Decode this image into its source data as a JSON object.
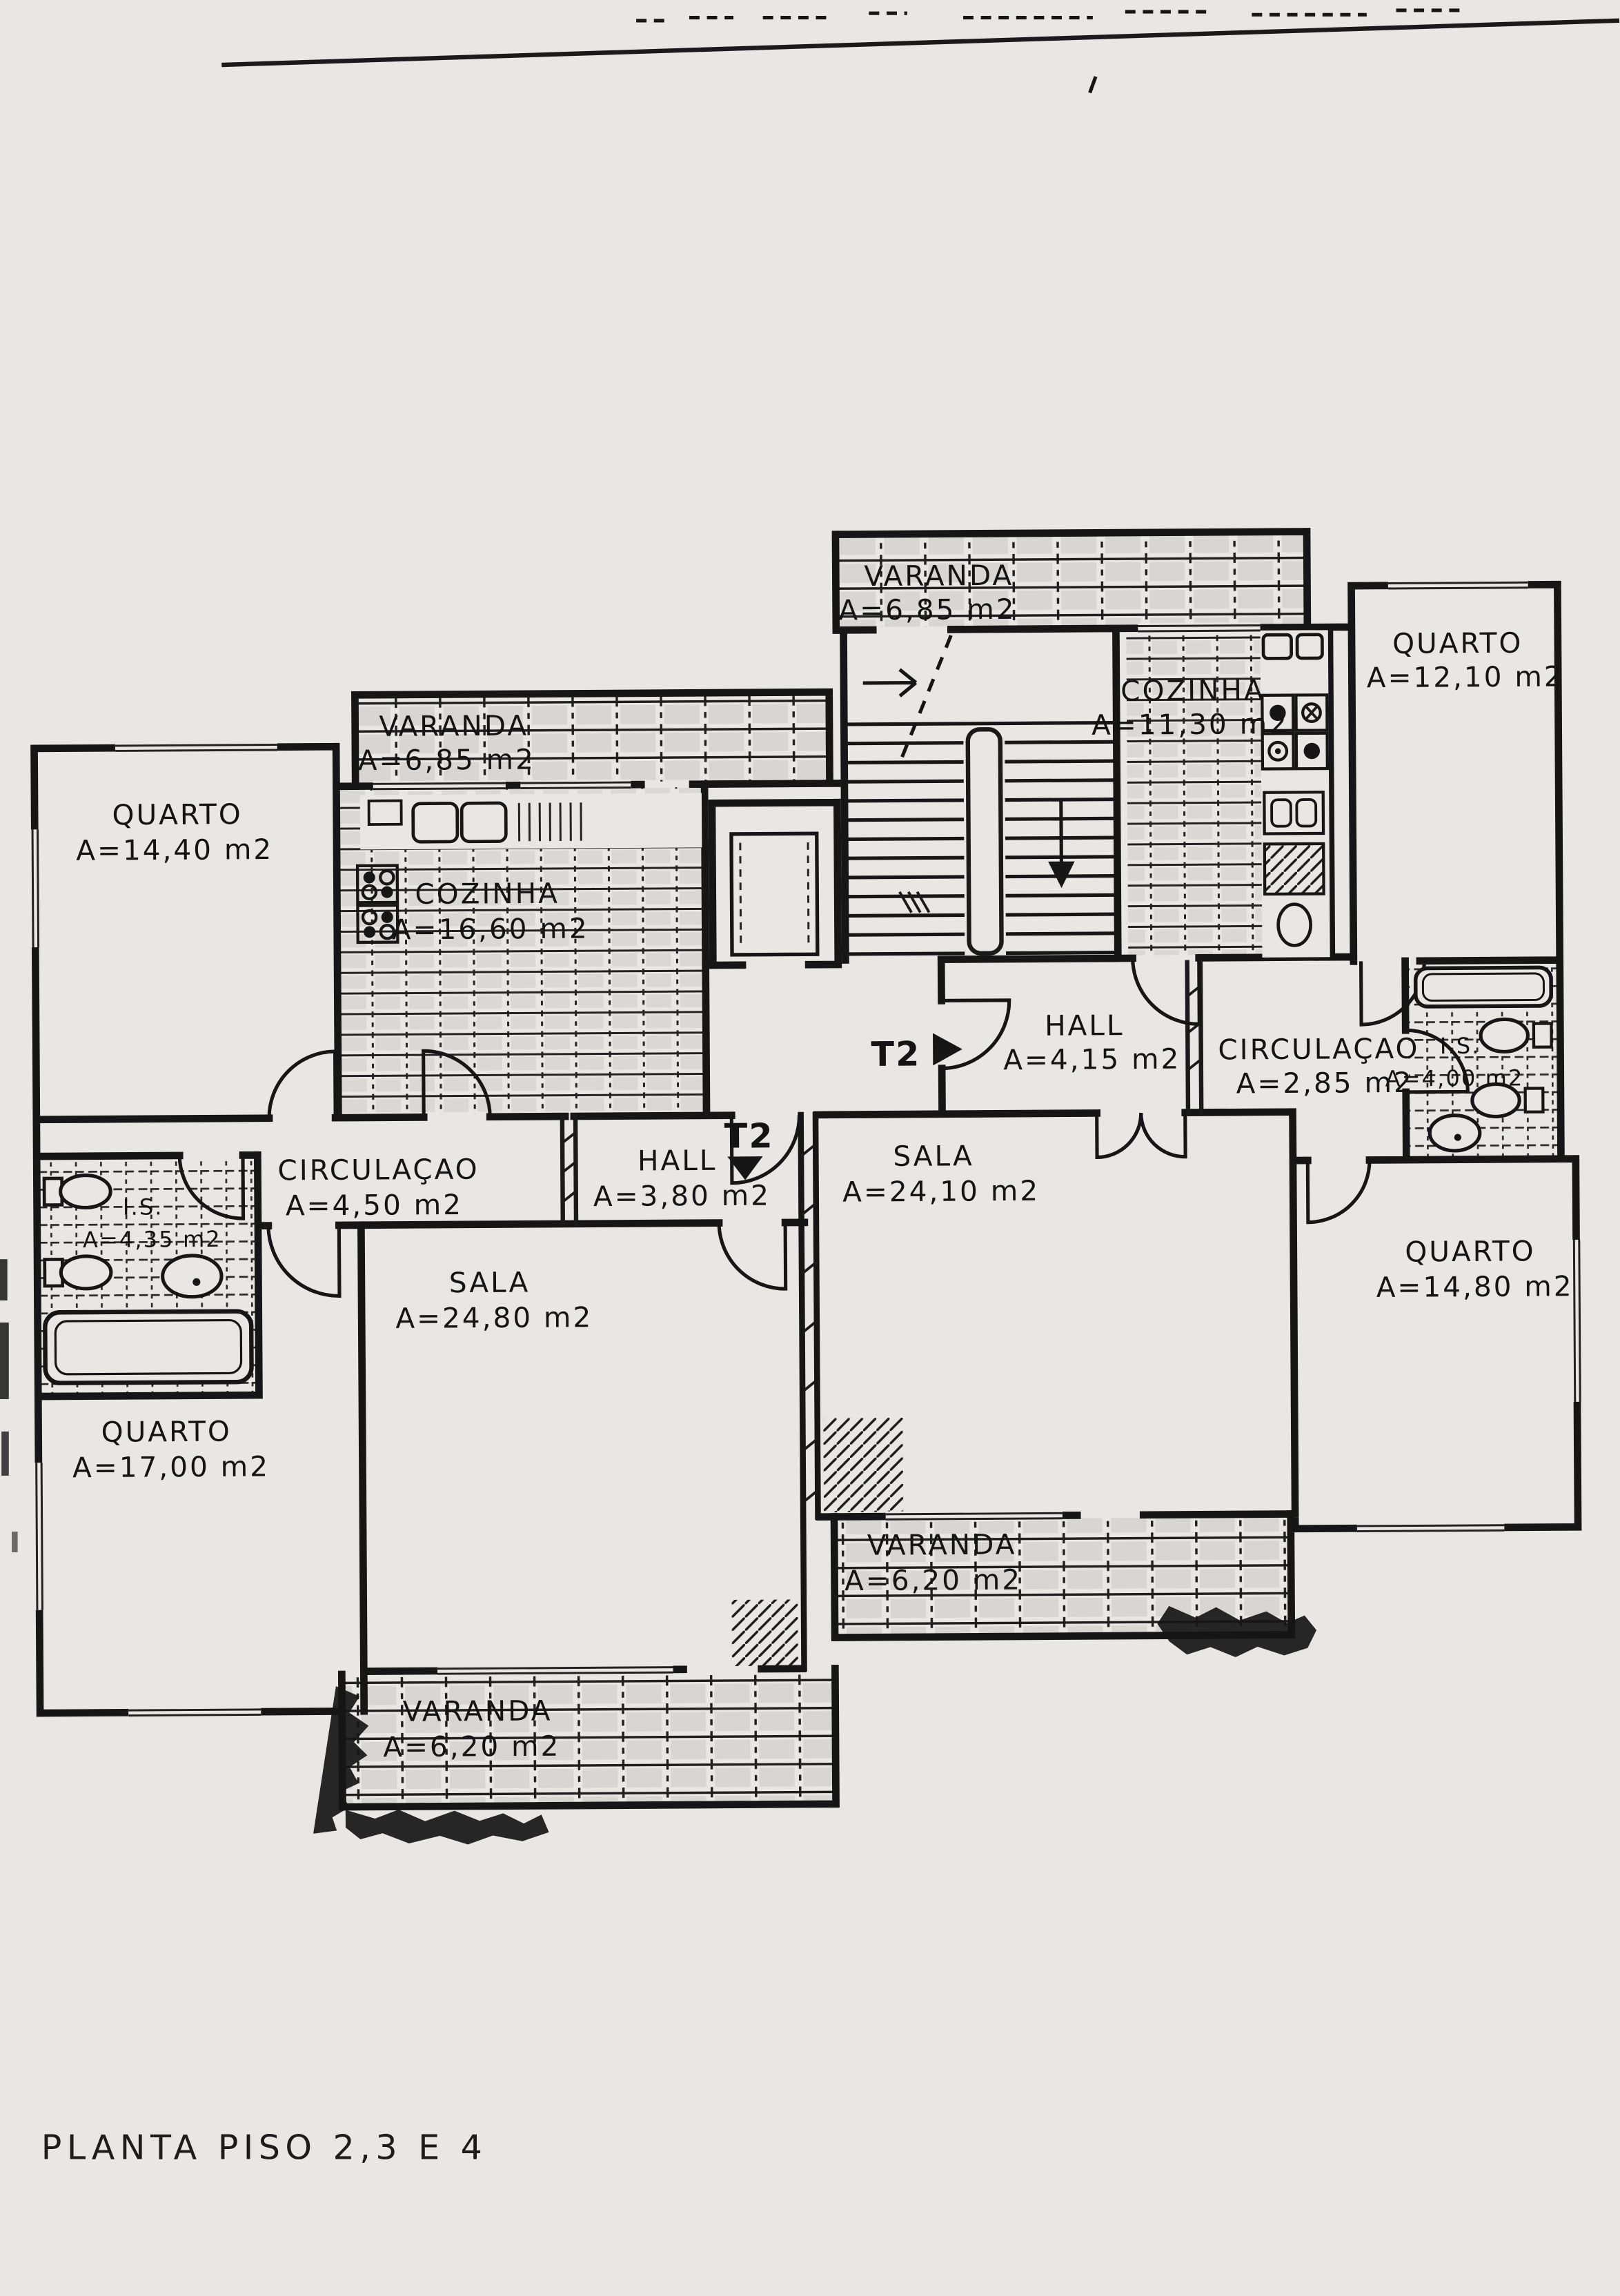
{
  "document": {
    "title": "PLANTA PISO 2,3 E 4",
    "type": "architectural floor plan scan"
  },
  "colors": {
    "paper": "#e9e7e4",
    "ink": "#161616"
  },
  "apartment_marks": {
    "t2_right": {
      "label": "T2",
      "direction": "right"
    },
    "t2_left": {
      "label": "T2",
      "direction": "down"
    }
  },
  "rooms": [
    {
      "id": "varanda-top-center",
      "name": "VARANDA",
      "area": "A=6,85 m2"
    },
    {
      "id": "quarto-top-right",
      "name": "QUARTO",
      "area": "A=12,10 m2"
    },
    {
      "id": "cozinha-right",
      "name": "COZINHA",
      "area": "A=11,30 m2"
    },
    {
      "id": "varanda-left",
      "name": "VARANDA",
      "area": "A=6,85 m2"
    },
    {
      "id": "quarto-top-left",
      "name": "QUARTO",
      "area": "A=14,40 m2"
    },
    {
      "id": "cozinha-left",
      "name": "COZINHA",
      "area": "A=16,60 m2"
    },
    {
      "id": "hall-right",
      "name": "HALL",
      "area": "A=4,15 m2"
    },
    {
      "id": "circulacao-right",
      "name": "CIRCULAÇAO",
      "area": "A=2,85 m2"
    },
    {
      "id": "is-right",
      "name": "I.S.",
      "area": "A=4,00 m2"
    },
    {
      "id": "circulacao-left",
      "name": "CIRCULAÇAO",
      "area": "A=4,50 m2"
    },
    {
      "id": "hall-left",
      "name": "HALL",
      "area": "A=3,80 m2"
    },
    {
      "id": "sala-right",
      "name": "SALA",
      "area": "A=24,10 m2"
    },
    {
      "id": "is-left",
      "name": "I.S.",
      "area": "A=4,35 m2"
    },
    {
      "id": "sala-left",
      "name": "SALA",
      "area": "A=24,80 m2"
    },
    {
      "id": "quarto-bottom-right",
      "name": "QUARTO",
      "area": "A=14,80 m2"
    },
    {
      "id": "quarto-bottom-left",
      "name": "QUARTO",
      "area": "A=17,00 m2"
    },
    {
      "id": "varanda-bottom-center",
      "name": "VARANDA",
      "area": "A=6,20 m2"
    },
    {
      "id": "varanda-bottom-left",
      "name": "VARANDA",
      "area": "A=6,20 m2"
    }
  ]
}
